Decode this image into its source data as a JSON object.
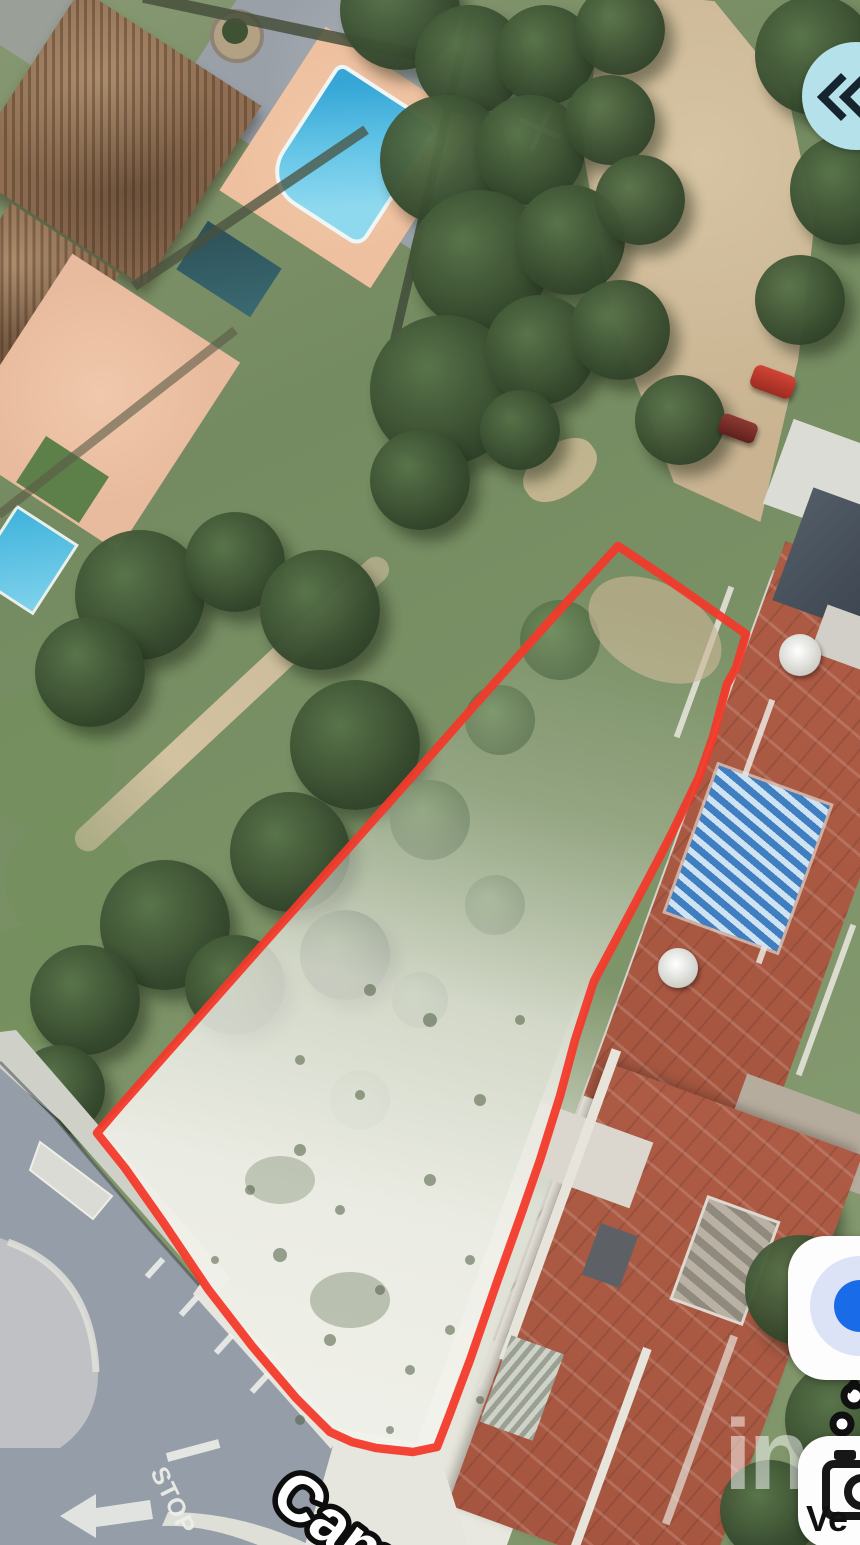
{
  "map": {
    "street_label": "Cam",
    "stop_marking": "STOP",
    "watermark": "in"
  },
  "controls": {
    "layers_button_color": "#b5e2ea",
    "location_dot_color": "#1a6be8",
    "photos_button_label": "Ve"
  },
  "colors": {
    "plot_outline": "#f23a2b",
    "roof_terracotta": "#ad5b44",
    "pool_blue": "#49b6dd"
  }
}
